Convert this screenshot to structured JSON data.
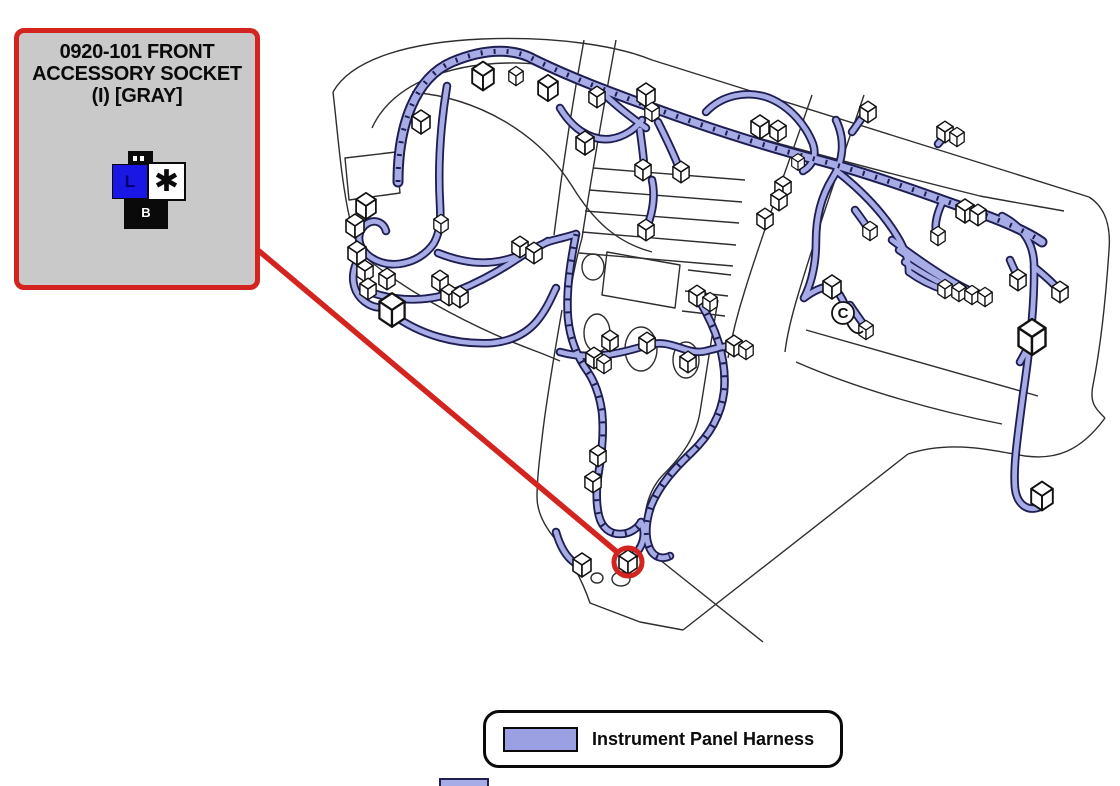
{
  "callout": {
    "title_line1": "0920-101 FRONT",
    "title_line2": "ACCESSORY SOCKET",
    "title_line3": "(I) [GRAY]",
    "connector_icon": {
      "left_cavity_label": "L",
      "right_cavity_label": "✱",
      "bottom_pin_label": "B"
    }
  },
  "legend": {
    "label": "Instrument Panel Harness"
  },
  "diagram": {
    "circled_component_symbol": "C",
    "connectors": [
      [
        421,
        122,
        1
      ],
      [
        483,
        76,
        1.2
      ],
      [
        516,
        76,
        0.8
      ],
      [
        548,
        88,
        1.1
      ],
      [
        597,
        97,
        0.9
      ],
      [
        646,
        95,
        1
      ],
      [
        652,
        112,
        0.8
      ],
      [
        585,
        143,
        1
      ],
      [
        760,
        127,
        1
      ],
      [
        778,
        131,
        0.9
      ],
      [
        783,
        187,
        0.9
      ],
      [
        779,
        200,
        0.9
      ],
      [
        765,
        219,
        0.9
      ],
      [
        798,
        162,
        0.7
      ],
      [
        870,
        231,
        0.8
      ],
      [
        868,
        112,
        0.9
      ],
      [
        945,
        132,
        0.9
      ],
      [
        957,
        137,
        0.8
      ],
      [
        965,
        211,
        1
      ],
      [
        978,
        215,
        0.9
      ],
      [
        938,
        236,
        0.8
      ],
      [
        832,
        287,
        1
      ],
      [
        945,
        289,
        0.8
      ],
      [
        959,
        292,
        0.8
      ],
      [
        972,
        295,
        0.8
      ],
      [
        985,
        297,
        0.8
      ],
      [
        1018,
        280,
        0.9
      ],
      [
        1060,
        292,
        0.9
      ],
      [
        1032,
        337,
        1.5
      ],
      [
        1042,
        496,
        1.2
      ],
      [
        866,
        330,
        0.8
      ],
      [
        366,
        206,
        1.1
      ],
      [
        355,
        226,
        1
      ],
      [
        357,
        253,
        1
      ],
      [
        365,
        271,
        0.9
      ],
      [
        368,
        289,
        0.9
      ],
      [
        392,
        310,
        1.4
      ],
      [
        387,
        279,
        0.9
      ],
      [
        441,
        224,
        0.8
      ],
      [
        520,
        247,
        0.9
      ],
      [
        534,
        253,
        0.9
      ],
      [
        440,
        281,
        0.9
      ],
      [
        449,
        295,
        0.9
      ],
      [
        460,
        297,
        0.9
      ],
      [
        594,
        358,
        0.9
      ],
      [
        604,
        364,
        0.8
      ],
      [
        643,
        170,
        0.9
      ],
      [
        681,
        172,
        0.9
      ],
      [
        646,
        230,
        0.9
      ],
      [
        610,
        341,
        0.9
      ],
      [
        647,
        343,
        0.9
      ],
      [
        688,
        362,
        0.9
      ],
      [
        734,
        346,
        0.9
      ],
      [
        746,
        350,
        0.8
      ],
      [
        697,
        296,
        0.9
      ],
      [
        710,
        302,
        0.8
      ],
      [
        598,
        456,
        0.9
      ],
      [
        593,
        482,
        0.9
      ],
      [
        582,
        565,
        1
      ],
      [
        628,
        562,
        1
      ]
    ]
  },
  "colors": {
    "harness_fill": "#a8ace6",
    "harness_outline": "#1e1e52",
    "outline": "#2e2e2e",
    "callout_red": "#d42420",
    "callout_box_fill": "#c9c9c9",
    "legend_swatch": "#9aa0e2",
    "connector_blue": "#1a16e3"
  }
}
